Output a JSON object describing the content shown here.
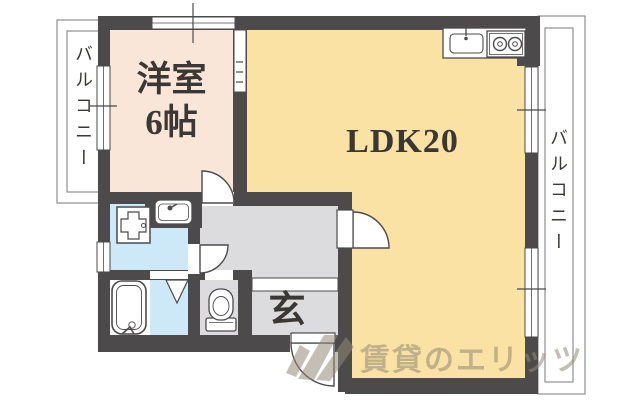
{
  "plan": {
    "rooms": {
      "western": {
        "name_line1": "洋室",
        "name_line2": "6帖"
      },
      "ldk": {
        "label": "LDK20"
      },
      "entrance": {
        "label": "玄"
      },
      "balcony_left": {
        "label": "バルコニー"
      },
      "balcony_right": {
        "label": "バルコニー"
      }
    },
    "watermark": {
      "text": "賃貸のエリッツ"
    },
    "colors": {
      "wall": "#4c4a4b",
      "western_room_floor": "#fae5d9",
      "ldk_floor": "#f9e2a3",
      "wet_area_floor": "#cde8f7",
      "hallway_floor": "#dcdcde",
      "balcony_line": "#8f8d8e",
      "watermark_text": "#988a76"
    },
    "icons": {
      "kitchen_sink": "kitchen-sink-icon",
      "stove": "stove-burners-icon",
      "washing_machine": "washing-machine-icon",
      "washbasin": "washbasin-icon",
      "bathtub": "bathtub-icon",
      "toilet": "toilet-icon",
      "bath_folding_door": "folding-door-icon",
      "door_swings": "door-swing-icon"
    }
  }
}
